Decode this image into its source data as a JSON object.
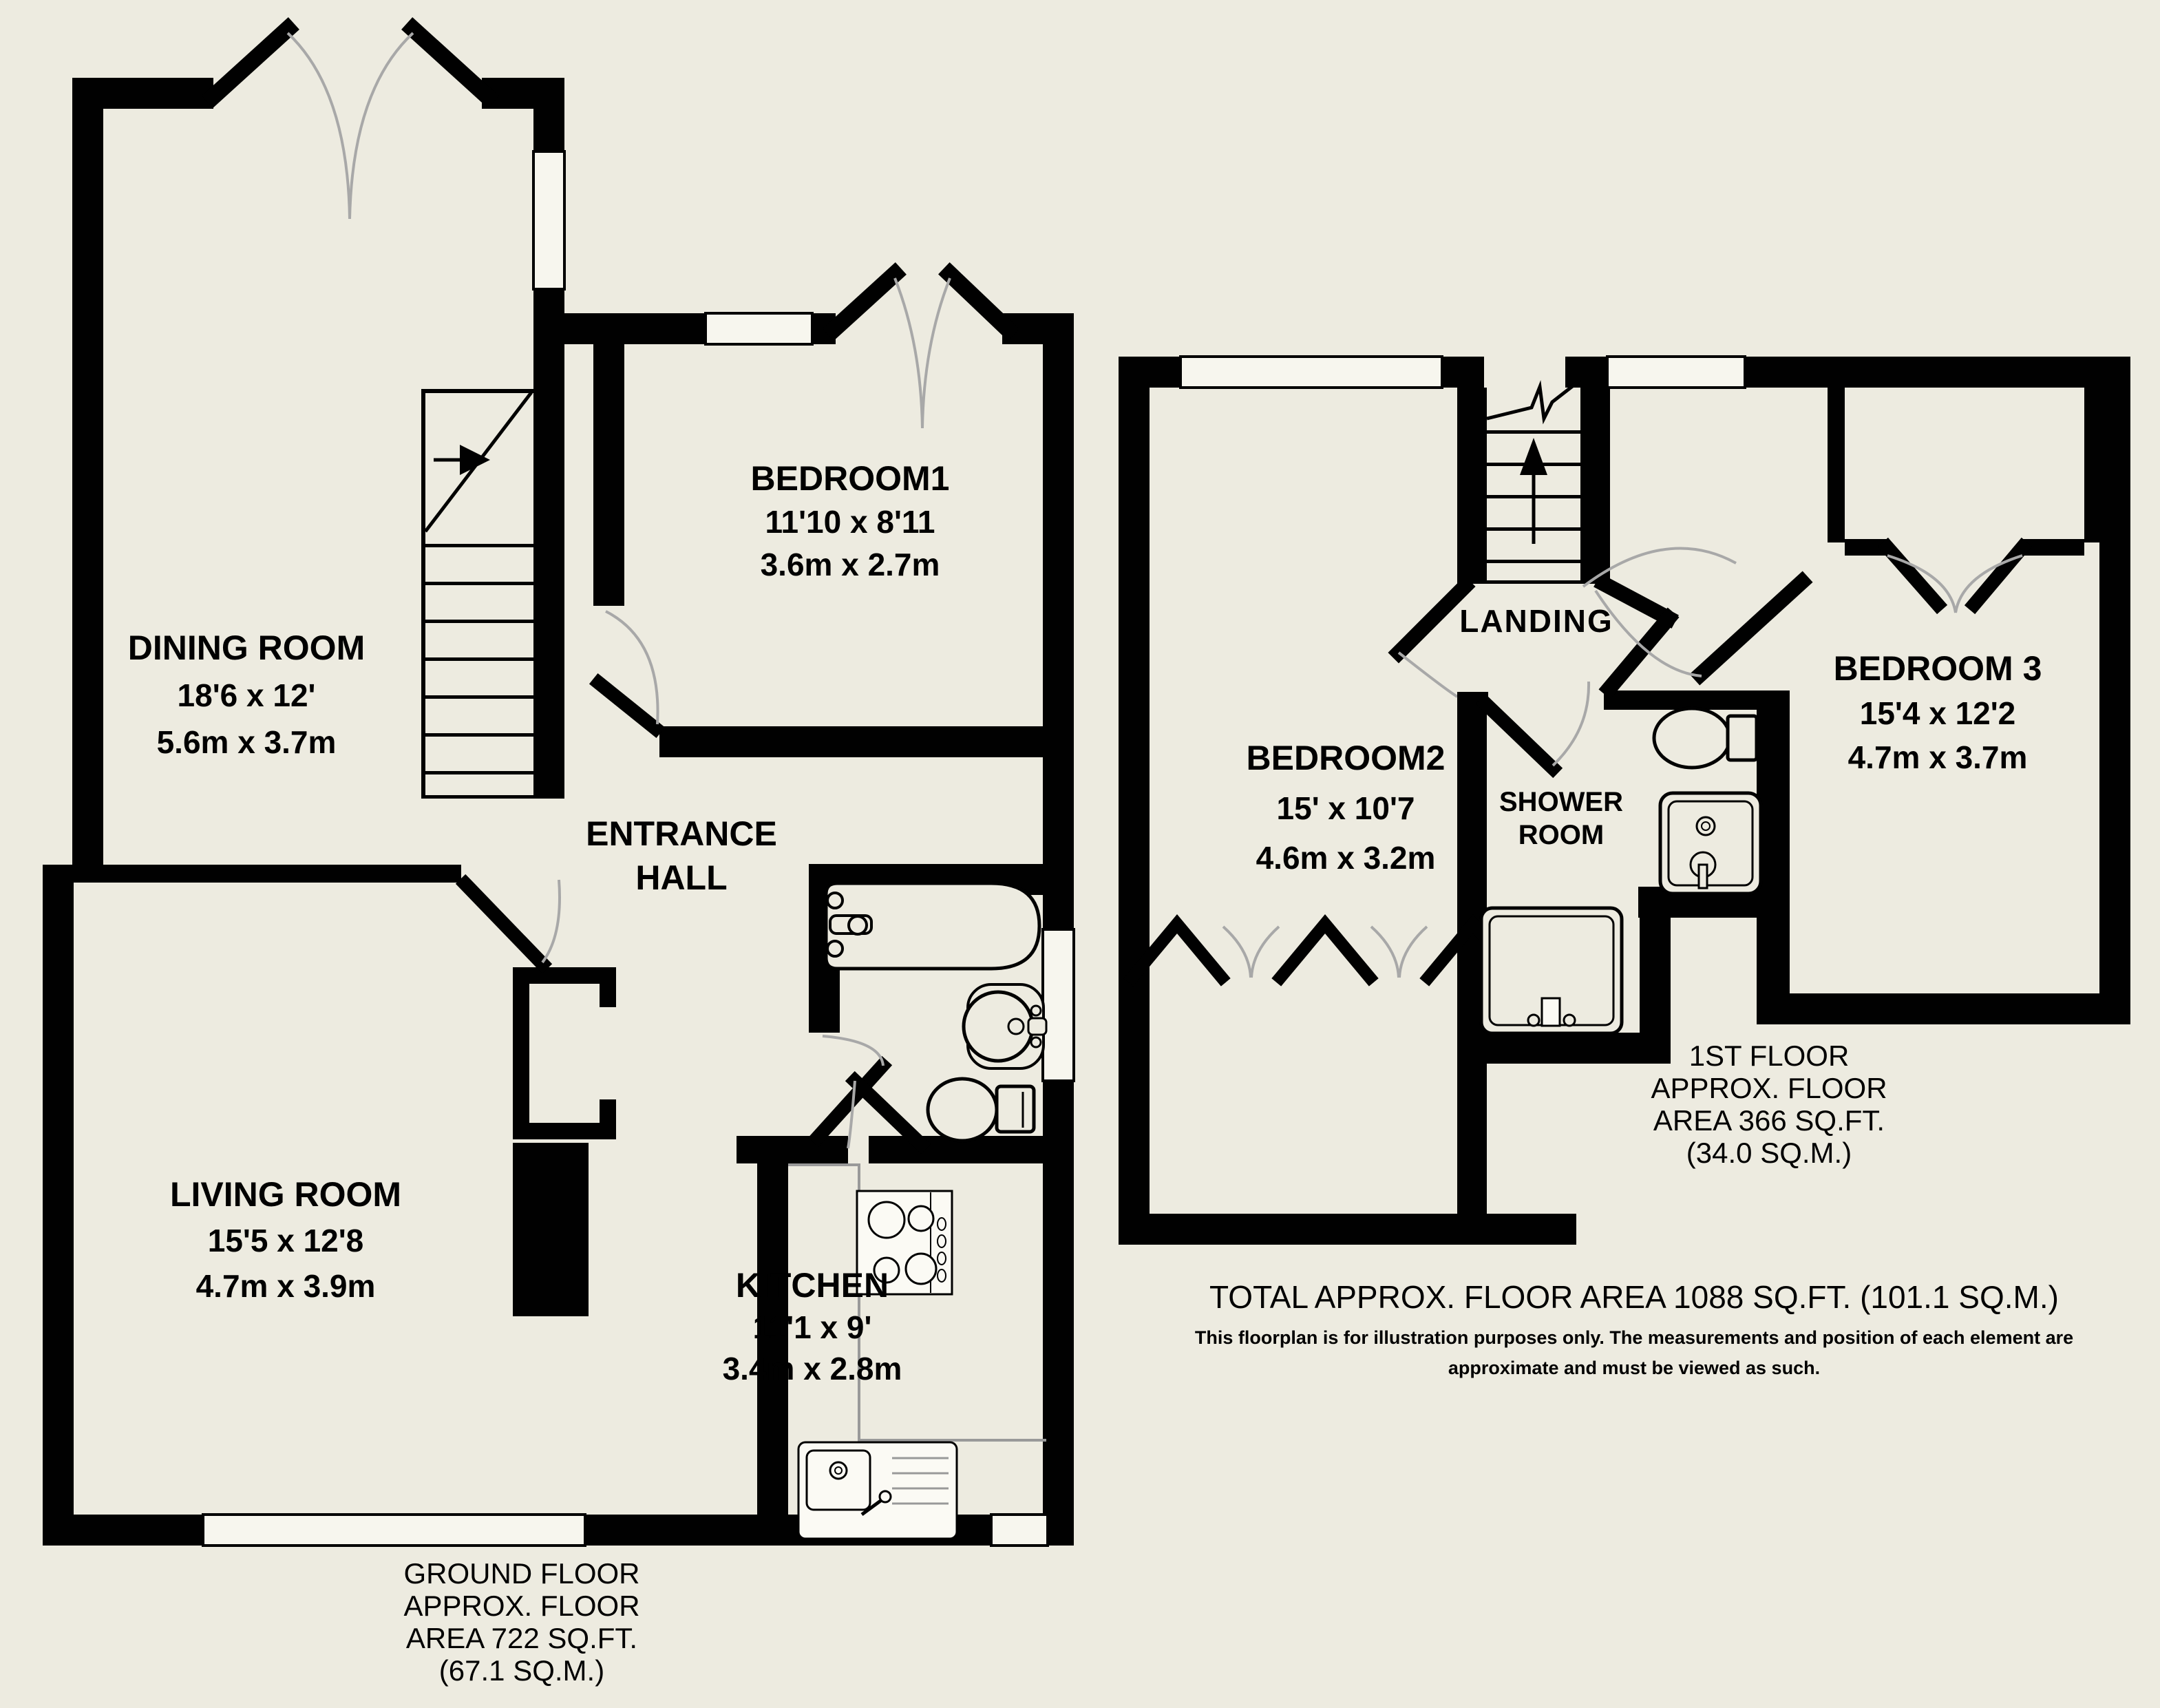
{
  "colors": {
    "background": "#EDEBE0",
    "wall": "#010101",
    "door_arc_grey": "#A8A8A8",
    "counter_grey": "#999999",
    "window_fill": "#F7F6EE"
  },
  "ground_floor": {
    "rooms": {
      "dining_room": {
        "name": "DINING ROOM",
        "imperial": "18'6 x 12'",
        "metric": "5.6m x 3.7m"
      },
      "bedroom1": {
        "name": "BEDROOM1",
        "imperial": "11'10 x 8'11",
        "metric": "3.6m x 2.7m"
      },
      "entrance_hall": {
        "name_line1": "ENTRANCE",
        "name_line2": "HALL"
      },
      "living_room": {
        "name": "LIVING ROOM",
        "imperial": "15'5 x 12'8",
        "metric": "4.7m x 3.9m"
      },
      "kitchen": {
        "name": "KITCHEN",
        "imperial": "11'1 x 9'",
        "metric": "3.4m x 2.8m"
      }
    },
    "caption": {
      "line1": "GROUND FLOOR",
      "line2": "APPROX. FLOOR",
      "line3": "AREA 722 SQ.FT.",
      "line4": "(67.1 SQ.M.)"
    }
  },
  "first_floor": {
    "rooms": {
      "bedroom2": {
        "name": "BEDROOM2",
        "imperial": "15' x 10'7",
        "metric": "4.6m x 3.2m"
      },
      "landing": {
        "name": "LANDING"
      },
      "shower_room": {
        "name_line1": "SHOWER",
        "name_line2": "ROOM"
      },
      "bedroom3": {
        "name": "BEDROOM 3",
        "imperial": "15'4 x 12'2",
        "metric": "4.7m x 3.7m"
      }
    },
    "caption": {
      "line1": "1ST FLOOR",
      "line2": "APPROX. FLOOR",
      "line3": "AREA 366 SQ.FT.",
      "line4": "(34.0 SQ.M.)"
    }
  },
  "footer": {
    "total_area": "TOTAL APPROX. FLOOR AREA 1088 SQ.FT. (101.1 SQ.M.)",
    "disclaimer_line1": "This floorplan is for illustration purposes only. The measurements and position of each element are",
    "disclaimer_line2": "approximate and must be viewed as such."
  }
}
